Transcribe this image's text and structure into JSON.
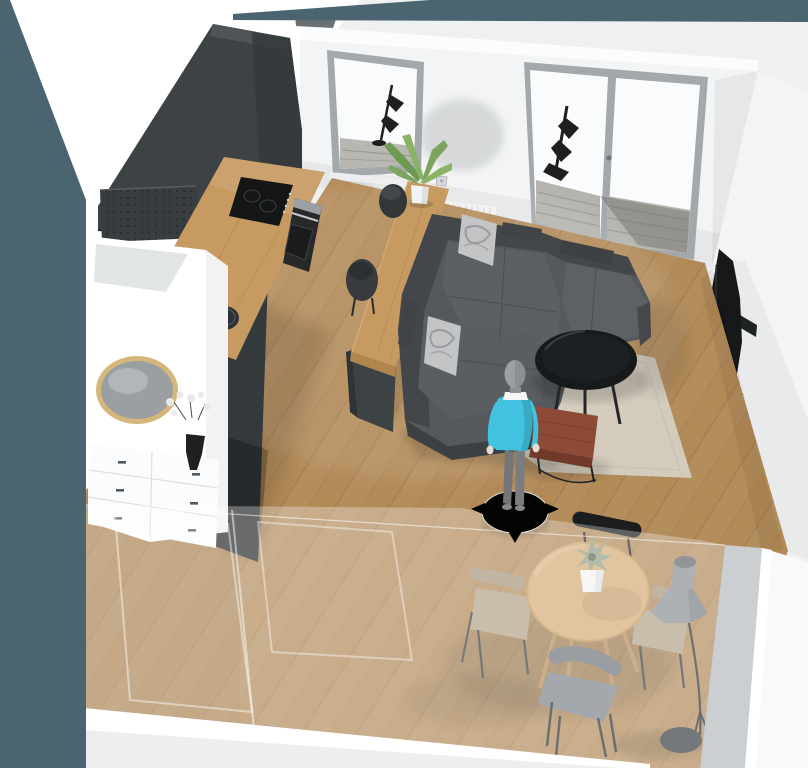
{
  "app": {
    "name": "3D home planner viewport",
    "view_mode": "3d-perspective-room-view",
    "canvas": {
      "width": 808,
      "height": 768
    }
  },
  "gizmo": {
    "type": "move-character",
    "arrows": [
      "left",
      "right",
      "down"
    ],
    "color": "#35b7d8",
    "disc_color": "#ffffff"
  },
  "scene": {
    "objects": [
      {
        "id": "kitchen-wall-cabinet",
        "label": "Tall charcoal kitchen cabinet wall"
      },
      {
        "id": "range-hood",
        "label": "Perforated range hood panel"
      },
      {
        "id": "kitchen-counter",
        "label": "Wood kitchen counter with cooktop, oven and sink"
      },
      {
        "id": "partition-wardrobe",
        "label": "White partition wardrobe with round mirror"
      },
      {
        "id": "drawer-unit",
        "label": "White drawer unit with vase of flowers"
      },
      {
        "id": "bar-counter",
        "label": "Wood bar counter with plant and stools"
      },
      {
        "id": "window",
        "label": "Window with lamp silhouette"
      },
      {
        "id": "french-door",
        "label": "Glass French door to balcony"
      },
      {
        "id": "radiator",
        "label": "Wall radiator"
      },
      {
        "id": "sectional-sofa",
        "label": "Charcoal L-shaped sofa with marbled cushions"
      },
      {
        "id": "rug",
        "label": "Beige area rug"
      },
      {
        "id": "coffee-table",
        "label": "Round black coffee table"
      },
      {
        "id": "bench-table",
        "label": "Red-brown bench table"
      },
      {
        "id": "avatar",
        "label": "Human figure with move gizmo"
      },
      {
        "id": "dining-table",
        "label": "Round wood dining table with succulent"
      },
      {
        "id": "dining-chairs",
        "label": "Four dining chairs"
      },
      {
        "id": "floor-lamp",
        "label": "Gray cone floor lamp"
      },
      {
        "id": "tv",
        "label": "Wall mounted TV"
      },
      {
        "id": "floor-plant",
        "label": "Large potted plant"
      },
      {
        "id": "glass-wall",
        "label": "Transparent front glass wall"
      }
    ]
  },
  "palette": {
    "teal_background": "#4a6470",
    "canvas_gray": "#eef0f1",
    "canvas_dot": "#d9dde0",
    "outside_white": "#ffffff",
    "wall_top_white": "#fbfcfd",
    "wall_white": "#f3f4f5",
    "wall_shadow_gray": "#c3c7c8",
    "inner_wall_gray": "#cbcfd1",
    "front_wall_white": "#f8f9fa",
    "top_object_gray": "#6b7073",
    "charcoal": "#3d4245",
    "charcoal_dark": "#34393c",
    "charcoal_deep": "#2e3335",
    "charcoal_light": "#51565a",
    "hood_gray": "#383d40",
    "hood_dot": "#202427",
    "counter_wood": "#c79a61",
    "counter_wood_side": "#b1854e",
    "counter_grain": "#a87e46",
    "cooktop_black": "#141617",
    "oven_black": "#26282a",
    "steel_gray": "#9aa0a3",
    "sink_black": "#2d3133",
    "window_frame": "#a3a8aa",
    "glass_white": "#fafbfc",
    "balcony_gray": "#b5b3ae",
    "balcony_slat": "#8f8d88",
    "radiator_white": "#f1f2f3",
    "radiator_line": "#d7d8da",
    "silhouette_black": "#1d1f21",
    "tv_black": "#17181a",
    "sideboard_white": "#edeff0",
    "pot_gray": "#7d8284",
    "pot_white": "#f2f3f4",
    "plant_green": "#46523b",
    "plant_green_dark": "#333e2b",
    "plant_green_light": "#5a684c",
    "leaf_green": "#7da45e",
    "leaf_green_light": "#8ab368",
    "leaf_green_dark": "#6f9a52",
    "floor_wood": "#b28a58",
    "floor_seam": "#7c5c36",
    "rug_beige": "#d6d0c4",
    "rug_edge": "#c6c0b2",
    "sofa_gray": "#55595c",
    "sofa_dark": "#43474a",
    "sofa_light": "#5e6265",
    "sofa_face": "#3c4043",
    "pillow_marble": "#c2c4c5",
    "pillow_swirl": "#8e9193",
    "coffee_table_black": "#17191b",
    "bench_brown": "#8c4a37",
    "bench_brown_dark": "#70392a",
    "dining_wood": "#d4ac74",
    "dining_wood_edge": "#c0975d",
    "chair_black": "#1b1d1e",
    "chair_tan": "#b2a188",
    "chair_tan_dark": "#a6957d",
    "chair_gray": "#6f757a",
    "chair_gray_light": "#7c838a",
    "lamp_gray": "#8b9094",
    "lamp_dark": "#3a3e41",
    "mirror_rim": "#d7b67c",
    "mirror_glass": "#9aa0a2",
    "succulent_green": "#94a085",
    "vase_black": "#1e2022",
    "flower_white": "#e8e9ea",
    "avatar_shirt": "#41c2de",
    "avatar_pants": "#737577",
    "avatar_skin": "#e6ddd0",
    "avatar_head": "#9da0a3",
    "wood_leg": "#b68c58"
  }
}
